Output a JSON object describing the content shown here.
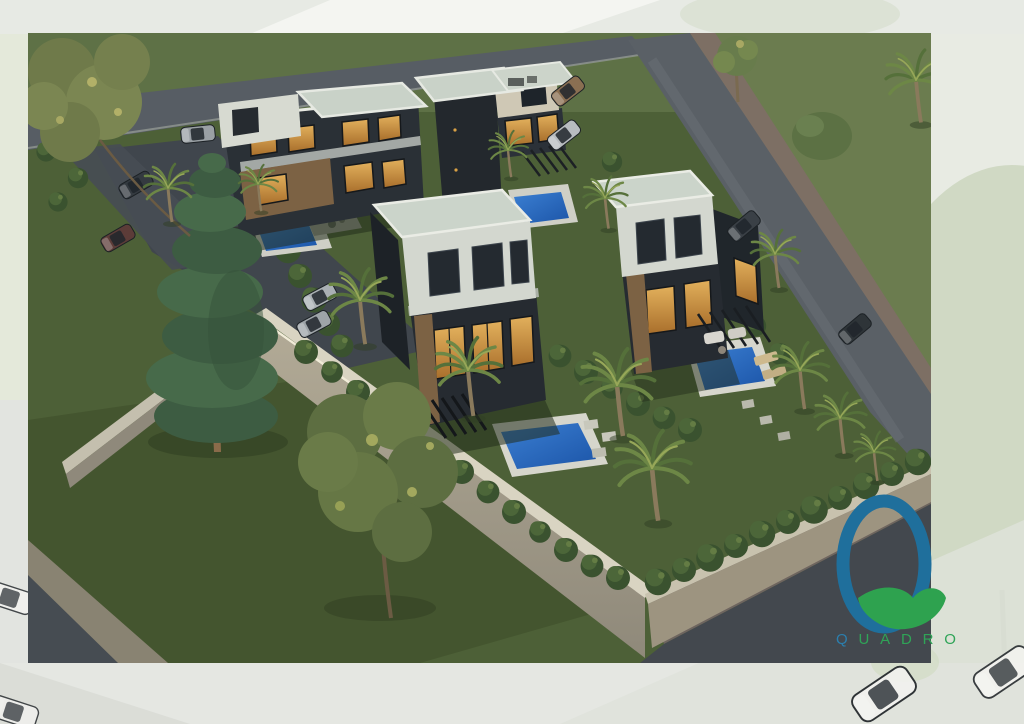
{
  "logo": {
    "monogram_letter": "Q",
    "wordmark": "QUADRO",
    "letter_colors": [
      "#2b7fae",
      "#2fa457",
      "#2fa457",
      "#2fa457",
      "#2fa457",
      "#2fa457"
    ],
    "ring_color": "#1f6f9c",
    "swoosh_color": "#2ea24f"
  },
  "palette": {
    "backdrop": "#eef0ec",
    "grass_dark": "#4d6037",
    "grass_light": "#6b7c4f",
    "road_asphalt": "#575d64",
    "sidewalk_paver": "#7d6f64",
    "perimeter_wall": "#a59d8a",
    "hedge_green": "#3a522f",
    "building_dark": "#262b31",
    "building_stone": "#d3d7cf",
    "roof_pebble": "#cbd4ca",
    "wood_accent": "#7c6244",
    "window_lit": "#d9a145",
    "pool_water": "#2e6cc2",
    "pool_deck": "#d6d6cc"
  },
  "scene": {
    "description": "Aerial dusk rendering of four modern three-storey villas with private pools, palm trees, hedged gardens and perimeter walls, bordered by roads",
    "villa_count": 4,
    "pool_count": 4
  }
}
